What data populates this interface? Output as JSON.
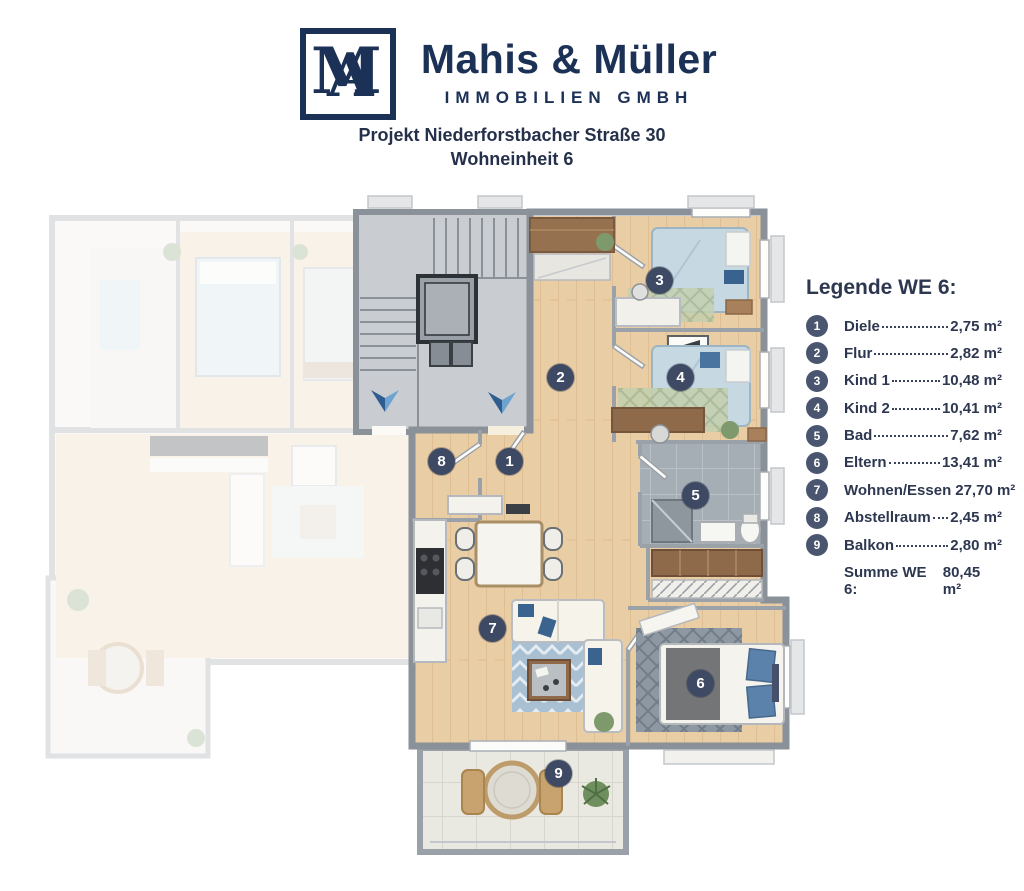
{
  "header": {
    "logo": {
      "letter_m": "M",
      "letter_a": "A"
    },
    "brand_name": "Mahis & Müller",
    "brand_subtitle": "IMMOBILIEN GMBH",
    "project_line1": "Projekt Niederforstbacher Straße 30",
    "project_line2": "Wohneinheit 6"
  },
  "legend": {
    "title": "Legende WE 6:",
    "items": [
      {
        "num": "1",
        "label": "Diele",
        "value": "2,75 m²"
      },
      {
        "num": "2",
        "label": "Flur",
        "value": "2,82 m²"
      },
      {
        "num": "3",
        "label": "Kind 1",
        "value": "10,48 m²"
      },
      {
        "num": "4",
        "label": "Kind 2",
        "value": "10,41 m²"
      },
      {
        "num": "5",
        "label": "Bad",
        "value": "7,62 m²"
      },
      {
        "num": "6",
        "label": "Eltern",
        "value": "13,41 m²"
      },
      {
        "num": "7",
        "label": "Wohnen/Essen",
        "value": "27,70 m²"
      },
      {
        "num": "8",
        "label": "Abstellraum",
        "value": "2,45 m²"
      },
      {
        "num": "9",
        "label": "Balkon",
        "value": "2,80 m²"
      }
    ],
    "summary_label": "Summe WE 6:",
    "summary_value": "80,45 m²"
  },
  "floorplan": {
    "markers": [
      {
        "num": "1"
      },
      {
        "num": "2"
      },
      {
        "num": "3"
      },
      {
        "num": "4"
      },
      {
        "num": "5"
      },
      {
        "num": "6"
      },
      {
        "num": "7"
      },
      {
        "num": "8"
      },
      {
        "num": "9"
      }
    ],
    "colors": {
      "brand_navy": "#1c3156",
      "marker_fill": "#3e4a64",
      "legend_circle": "#4a5570",
      "wood_floor": "#e9cda4",
      "bath_tile": "#a6aeb5",
      "entry_arrow_blue": "#2f5d91"
    }
  }
}
